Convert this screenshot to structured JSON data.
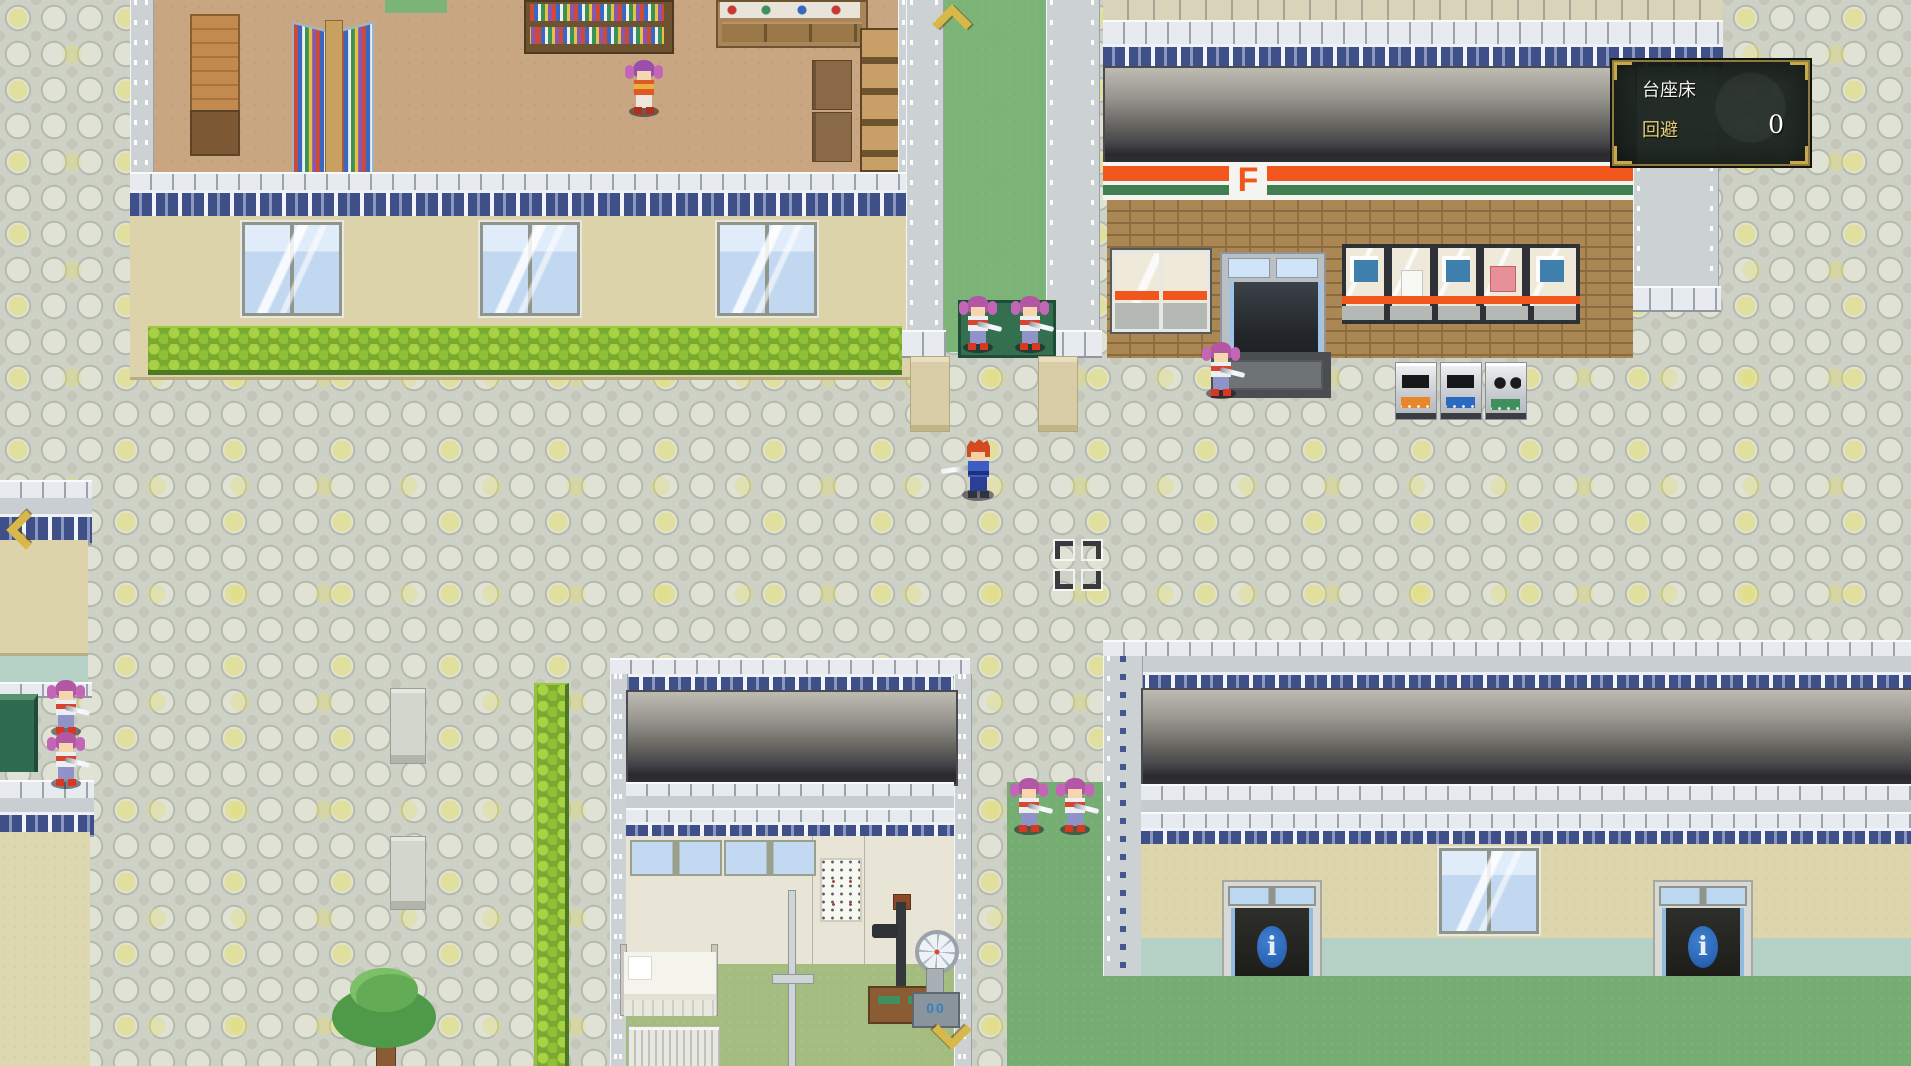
{
  "hud": {
    "terrain_panel": {
      "name_label": "台座床",
      "stat_label": "回避",
      "stat_value": "0",
      "frame_color": "#C9A84C",
      "stat_label_color": "#E6D07C"
    }
  },
  "map": {
    "store": {
      "logo_letter": "F",
      "brand_orange": "#F1571C",
      "brand_green": "#417E52"
    },
    "info_building": {
      "door_sign_letter": "i",
      "sign_color": "#2A64B4"
    },
    "icons": {
      "map_arrow_up": "gold-chevron-up",
      "map_arrow_left": "gold-chevron-left",
      "map_arrow_down_right": "gold-chevron-down",
      "target_cursor": "corner-brackets"
    },
    "palette": {
      "pavement": "#CED1C5",
      "pavement_accent": "#E2DD6E",
      "grass": "#76AD72",
      "hedge": "#79A92E",
      "brick": "#AA8753",
      "roof_dark": "#2A2A2E",
      "library_floor": "#C9A682",
      "wall_tan": "#DDD3AB"
    }
  }
}
